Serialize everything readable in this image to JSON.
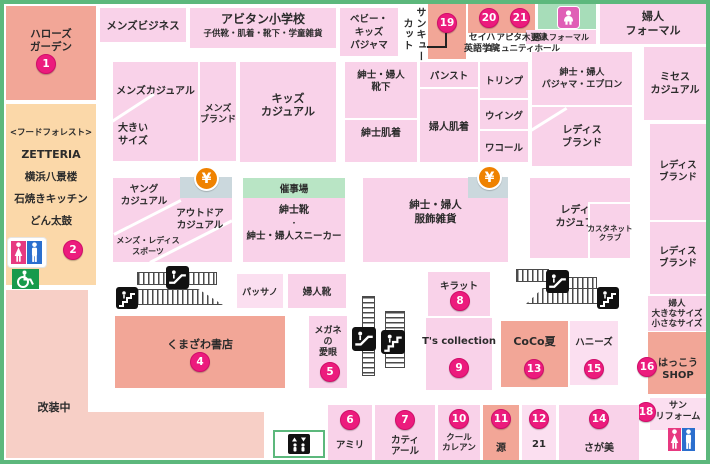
{
  "map": {
    "atm_symbol": "¥",
    "colors": {
      "area_pink": "#f9d2e9",
      "area_pink_light": "#fbdff0",
      "tenant_salmon": "#f2a697",
      "renovation_pink": "#f7cfc6",
      "restaurant_peach": "#fbd8a9",
      "event_green": "#b9e5c5",
      "service_green": "#a7ddb9",
      "atm_panel": "#cbd8dd",
      "badge_magenta": "#ec1b7d",
      "border_green": "#5cb87c",
      "atm_orange": "#ef8200",
      "male_blue": "#2b6fce",
      "female_pink": "#e73980",
      "wheelchair_green": "#189a4c"
    },
    "icons": [
      "restroom-icon",
      "wheelchair-icon",
      "atm-yen-icon",
      "escalator-icon",
      "stairs-icon",
      "elevator-icon",
      "baby-room-icon"
    ],
    "areas": [
      {
        "id": "hellos-garden",
        "lines": [
          "ハローズ",
          "ガーデン"
        ],
        "badge": "1"
      },
      {
        "id": "food-forest",
        "lines": [
          "<フードフォレスト>",
          "ZETTERIA",
          "横浜八景楼",
          "石焼きキッチン",
          "どん太鼓"
        ],
        "badge": "2"
      },
      {
        "id": "renovation-a"
      },
      {
        "id": "renovation-b"
      },
      {
        "id": "renovation-label",
        "lines": [
          "改装中"
        ]
      },
      {
        "id": "mens-business",
        "lines": [
          "メンズビジネス"
        ]
      },
      {
        "id": "abitan-school",
        "lines": [
          "アビタン小学校",
          "子供靴・肌着・靴下・学童雑貨"
        ]
      },
      {
        "id": "baby-kids-pajama",
        "lines": [
          "ベビー・",
          "キッズ",
          "パジャマ"
        ]
      },
      {
        "id": "thankyou-cut-label",
        "lines": [
          "サンキュー",
          "カット"
        ]
      },
      {
        "id": "shop-19",
        "badge": "19"
      },
      {
        "id": "shop-20",
        "badge": "20"
      },
      {
        "id": "shop-21",
        "badge": "21"
      },
      {
        "id": "seiha-label",
        "lines": [
          "セイハ",
          "英語学院"
        ]
      },
      {
        "id": "apita-hall-label",
        "lines": [
          "アピタ木更津",
          "コミュニティホール"
        ]
      },
      {
        "id": "baby-room-block"
      },
      {
        "id": "fujin-formal-small",
        "lines": [
          "婦人フォーマル"
        ]
      },
      {
        "id": "fujin-formal-big",
        "lines": [
          "婦人",
          "フォーマル"
        ]
      },
      {
        "id": "mens-casual",
        "lines": [
          "メンズカジュアル"
        ]
      },
      {
        "id": "large-size-label",
        "lines": [
          "大きい",
          "サイズ"
        ]
      },
      {
        "id": "mens-brand",
        "lines": [
          "メンズ",
          "ブランド"
        ]
      },
      {
        "id": "kids-casual",
        "lines": [
          "キッズ",
          "カジュアル"
        ]
      },
      {
        "id": "socks",
        "lines": [
          "紳士・婦人",
          "靴下"
        ]
      },
      {
        "id": "panst",
        "lines": [
          "パンスト"
        ]
      },
      {
        "id": "triumph",
        "lines": [
          "トリンプ"
        ]
      },
      {
        "id": "wing",
        "lines": [
          "ウイング"
        ]
      },
      {
        "id": "wacoal",
        "lines": [
          "ワコール"
        ]
      },
      {
        "id": "mens-underwear",
        "lines": [
          "紳士肌着"
        ]
      },
      {
        "id": "womens-underwear",
        "lines": [
          "婦人肌着"
        ]
      },
      {
        "id": "pajama-apron",
        "lines": [
          "紳士・婦人",
          "パジャマ・エプロン"
        ]
      },
      {
        "id": "mrs-casual",
        "lines": [
          "ミセス",
          "カジュアル"
        ]
      },
      {
        "id": "ladies-brand-center",
        "lines": [
          "レディス",
          "ブランド"
        ]
      },
      {
        "id": "ladies-brand-right-upper",
        "lines": [
          "レディス",
          "ブランド"
        ]
      },
      {
        "id": "ladies-brand-right-lower",
        "lines": [
          "レディス",
          "ブランド"
        ]
      },
      {
        "id": "fujin-sizes",
        "lines": [
          "婦人",
          "大きなサイズ",
          "小さなサイズ"
        ]
      },
      {
        "id": "young-zone"
      },
      {
        "id": "young-casual-label",
        "lines": [
          "ヤング",
          "カジュアル"
        ]
      },
      {
        "id": "outdoor-casual-label",
        "lines": [
          "アウトドア",
          "カジュアル"
        ]
      },
      {
        "id": "sports-label",
        "lines": [
          "メンズ・レディス",
          "スポーツ"
        ]
      },
      {
        "id": "atm-left-panel"
      },
      {
        "id": "event-hall",
        "lines": [
          "催事場"
        ]
      },
      {
        "id": "shoes-sneaker",
        "lines": [
          "紳士靴",
          "・",
          "紳士・婦人スニーカー"
        ]
      },
      {
        "id": "accessories",
        "lines": [
          "紳士・婦人",
          "服飾雑貨"
        ]
      },
      {
        "id": "atm-right-panel"
      },
      {
        "id": "ladies-casual",
        "lines": [
          "レディス",
          "カジュアル"
        ]
      },
      {
        "id": "castanet-club",
        "lines": [
          "カスタネット",
          "クラブ"
        ]
      },
      {
        "id": "passano",
        "lines": [
          "パッサノ"
        ]
      },
      {
        "id": "fujin-kutsu",
        "lines": [
          "婦人靴"
        ]
      },
      {
        "id": "kirat",
        "lines": [
          "キラット"
        ],
        "badge": "8"
      },
      {
        "id": "megane-aigan",
        "lines": [
          "メガネ",
          "の",
          "愛眼"
        ],
        "badge": "5"
      },
      {
        "id": "ts-collection",
        "lines": [
          "T's collection"
        ],
        "badge": "9"
      },
      {
        "id": "kumazawa-books",
        "lines": [
          "くまざわ書店"
        ],
        "badge": "4"
      },
      {
        "id": "coco-natsu",
        "lines": [
          "CoCo夏"
        ],
        "badge": "13"
      },
      {
        "id": "honeys",
        "lines": [
          "ハニーズ"
        ],
        "badge": "15"
      },
      {
        "id": "hakko-shop",
        "lines": [
          "はっこう",
          "SHOP"
        ],
        "badge": "16"
      },
      {
        "id": "sun-reform",
        "lines": [
          "サン",
          "リフォーム"
        ],
        "badge": "18"
      },
      {
        "id": "amiri",
        "lines": [
          "アミリ"
        ],
        "badge": "6"
      },
      {
        "id": "katy-earl",
        "lines": [
          "カティ",
          "アール"
        ],
        "badge": "7"
      },
      {
        "id": "cool-carean",
        "lines": [
          "クール",
          "カレアン"
        ],
        "badge": "10"
      },
      {
        "id": "minamoto",
        "lines": [
          "源"
        ],
        "badge": "11"
      },
      {
        "id": "twenty-one",
        "lines": [
          "21"
        ],
        "badge": "12"
      },
      {
        "id": "sagami",
        "lines": [
          "さが美"
        ],
        "badge": "14"
      },
      {
        "id": "elevator-box"
      }
    ]
  }
}
